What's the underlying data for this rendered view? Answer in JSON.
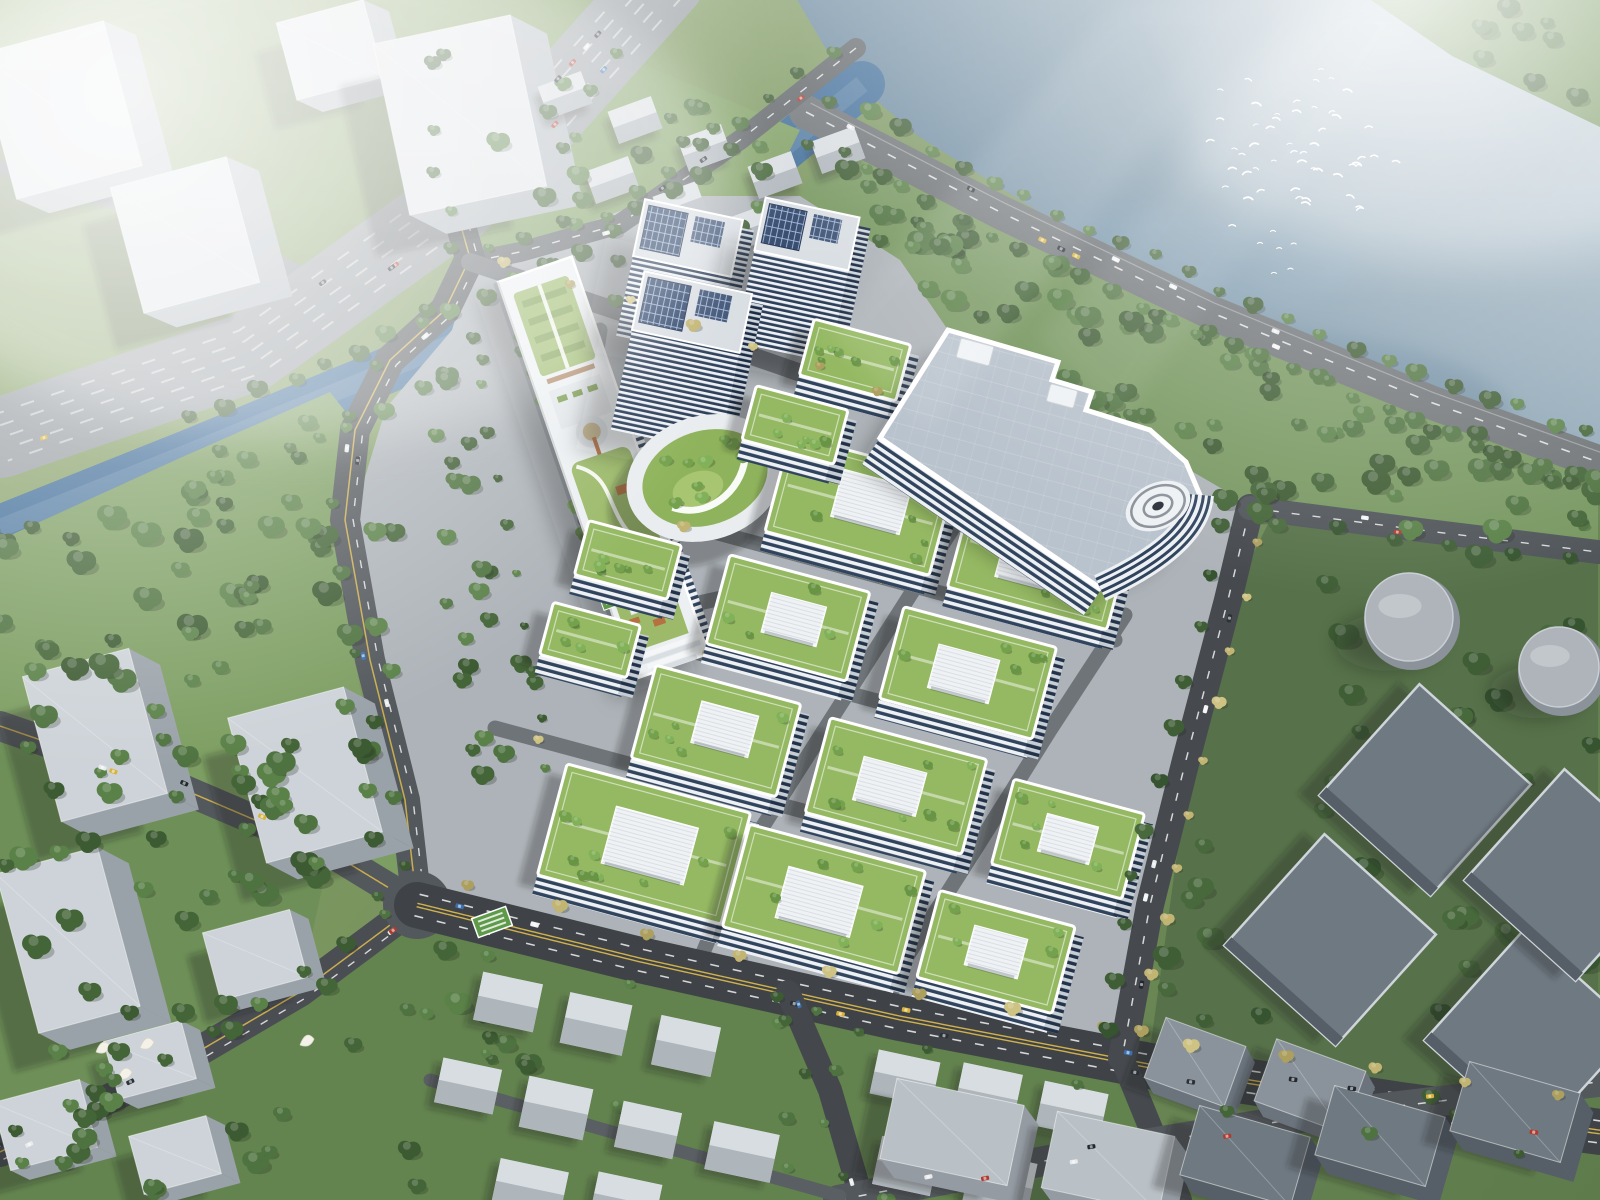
{
  "meta": {
    "title": "Aerial rendering of a riverside eco business campus",
    "type": "architectural-visualization",
    "view": "aerial-oblique",
    "atmosphere": "hazy daylight, sun glare upper-right, fog upper-left"
  },
  "colors": {
    "ground_light": "#8ea76c",
    "ground_dark": "#5d7b4b",
    "grass_park": "#779760",
    "grass_park_west": "#7d9e62",
    "grass_industrial": "#57724a",
    "grass_south": "#62824e",
    "grass_bottom_left": "#6e9058",
    "lake_light": "#aabdc9",
    "lake_mid": "#7b96a8",
    "lake_deep": "#62819a",
    "river": "#3f6c98",
    "river_sheen": "#8fb0ca",
    "canal": "#4c79a6",
    "road_highway": "#979da2",
    "road_major": "#3f4347",
    "road_mid": "#53585c",
    "road_minor": "#5f6468",
    "road_internal": "#6e7478",
    "lane_white": "#eef0f1",
    "lane_yellow": "#d8b74e",
    "median_green": "#6d8a55",
    "pavement": "#adb3b8",
    "pavement_light": "#c2c7cb",
    "building_white": "#eff2f5",
    "parapet_white": "#ffffff",
    "facade_light": "#eef1f4",
    "facade_dark": "#31445e",
    "facade_shaded_light": "#c6cdd4",
    "facade_shaded_dark": "#223349",
    "tower_band_light": "#edf1f5",
    "tower_band_dark": "#2c3e58",
    "tower_side_light": "#cfd6dd",
    "tower_side_dark": "#1c2c44",
    "tower_roof": "#d9dee3",
    "solar_panel": "#2e4468",
    "solar_grid": "#9fb6d8",
    "louver_line": "#c4cbd1",
    "big_roof": "#b9c3cd",
    "green_roof": "#95b963",
    "green_roof_light": "#a8c672",
    "garden_lawn": "#9cba6a",
    "deck_orange": "#b5713f",
    "context_top": "#dfe3e7",
    "context_side": "#b2b9bf",
    "slab_top": "#cdd3d8",
    "slab_side": "#9aa2a9",
    "house_top": "#d8dde1",
    "house_side": "#aeb5bb",
    "house_base": "#c6cdd2",
    "warehouse_top": "#6f7982",
    "warehouse_side": "#565f68",
    "warehouse_edge": "#cfd5da",
    "tank_top": "#aeb4ba",
    "tank_side": "#8b9299",
    "sign_green": "#5e9a4a",
    "tree_park": [
      "#4f7340",
      "#446538",
      "#5a8148",
      "#3d5b32"
    ],
    "tree_roof": [
      "#74a24c",
      "#81b158",
      "#689544"
    ],
    "tree_autumn": [
      "#c2b472",
      "#cfc384",
      "#ad9f5e"
    ],
    "tree_dark": [
      "#3f5e36",
      "#48693c",
      "#365430"
    ],
    "car_colors": [
      "#f2f4f5",
      "#2b3138",
      "#b03a2e",
      "#d9b23a",
      "#3a6fb0",
      "#23282e",
      "#e8eaec"
    ],
    "bird_white": "#ffffff",
    "shadow": "rgba(25,33,28,0.30)",
    "fog": "#ffffff"
  },
  "scene": {
    "water": {
      "lake": "wide river bend filling upper-right",
      "river": "tributary flowing to lower-left",
      "canal": "narrow stream beside linear garden building",
      "bird_flock_count": 52
    },
    "campus": {
      "high_rise_towers": 3,
      "tower_style": "white banded floors with rooftop solar arrays",
      "green_roof_office_blocks": 10,
      "stepped_garden_blocks": 4,
      "linear_roof_garden_building": 1,
      "large_flat_roof_building": 1,
      "spiral_parking_ramp": 1,
      "oval_garden_courtyard": 1,
      "entrance_sign": "green louvered gateway at south-west plaza"
    },
    "surroundings": {
      "context_towers_upper_left": 4,
      "gray_slab_towers_lower_left": 3,
      "village_houses_top_center": 8,
      "residential_houses_bottom": 14,
      "industrial_warehouses_right": 4,
      "storage_tanks": 2,
      "white_sculptures": "abstract bird sculptures on lower-left roadside"
    },
    "traffic": {
      "cars_total_approx": 60
    }
  }
}
